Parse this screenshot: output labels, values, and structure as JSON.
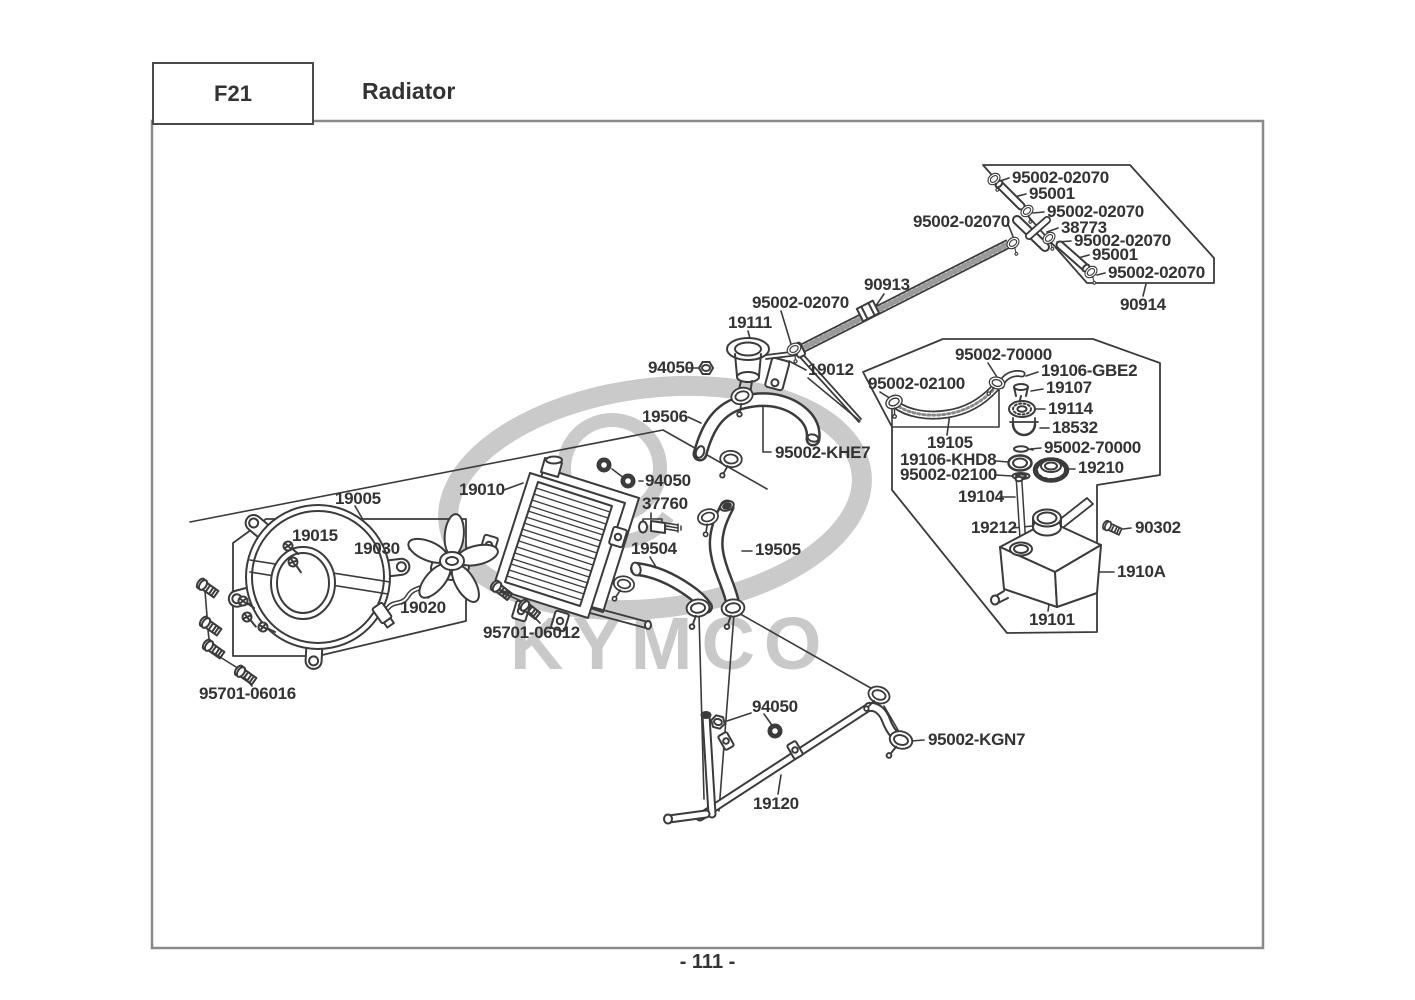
{
  "page": {
    "section_code": "F21",
    "title": "Radiator",
    "page_number": "- 111 -",
    "watermark": "KYMCO",
    "colors": {
      "line": "#3b3b3b",
      "label": "#333333",
      "watermark": "#c9c9c9",
      "border": "#8a8a8a"
    }
  },
  "labels": [
    {
      "text": "95002-02070",
      "x": 1012,
      "y": 178
    },
    {
      "text": "95001",
      "x": 1029,
      "y": 194
    },
    {
      "text": "95002-02070",
      "x": 1047,
      "y": 212
    },
    {
      "text": "38773",
      "x": 1061,
      "y": 228
    },
    {
      "text": "95002-02070",
      "x": 1074,
      "y": 241
    },
    {
      "text": "95001",
      "x": 1092,
      "y": 255
    },
    {
      "text": "95002-02070",
      "x": 1108,
      "y": 273
    },
    {
      "text": "90914",
      "x": 1120,
      "y": 305
    },
    {
      "text": "95002-02070",
      "x": 913,
      "y": 222
    },
    {
      "text": "90913",
      "x": 864,
      "y": 285
    },
    {
      "text": "95002-02070",
      "x": 752,
      "y": 303
    },
    {
      "text": "19111",
      "x": 728,
      "y": 323
    },
    {
      "text": "94050",
      "x": 648,
      "y": 368
    },
    {
      "text": "19012",
      "x": 808,
      "y": 370
    },
    {
      "text": "95002-70000",
      "x": 955,
      "y": 355
    },
    {
      "text": "19106-GBE2",
      "x": 1041,
      "y": 371
    },
    {
      "text": "19107",
      "x": 1046,
      "y": 388
    },
    {
      "text": "19114",
      "x": 1048,
      "y": 409
    },
    {
      "text": "18532",
      "x": 1052,
      "y": 428
    },
    {
      "text": "95002-70000",
      "x": 1044,
      "y": 448
    },
    {
      "text": "19210",
      "x": 1078,
      "y": 468
    },
    {
      "text": "95002-02100",
      "x": 868,
      "y": 384
    },
    {
      "text": "19105",
      "x": 927,
      "y": 443
    },
    {
      "text": "19106-KHD8",
      "x": 900,
      "y": 460
    },
    {
      "text": "95002-02100",
      "x": 900,
      "y": 475
    },
    {
      "text": "19104",
      "x": 958,
      "y": 497
    },
    {
      "text": "19212",
      "x": 971,
      "y": 528
    },
    {
      "text": "90302",
      "x": 1135,
      "y": 528
    },
    {
      "text": "1910A",
      "x": 1117,
      "y": 572
    },
    {
      "text": "19101",
      "x": 1029,
      "y": 620
    },
    {
      "text": "19506",
      "x": 642,
      "y": 417
    },
    {
      "text": "95002-KHE7",
      "x": 775,
      "y": 453
    },
    {
      "text": "94050",
      "x": 645,
      "y": 481
    },
    {
      "text": "37760",
      "x": 642,
      "y": 504
    },
    {
      "text": "19504",
      "x": 631,
      "y": 549
    },
    {
      "text": "19505",
      "x": 755,
      "y": 550
    },
    {
      "text": "19010",
      "x": 459,
      "y": 490
    },
    {
      "text": "95701-06012",
      "x": 483,
      "y": 633
    },
    {
      "text": "19005",
      "x": 335,
      "y": 499
    },
    {
      "text": "19015",
      "x": 292,
      "y": 536
    },
    {
      "text": "19030",
      "x": 354,
      "y": 549
    },
    {
      "text": "19020",
      "x": 400,
      "y": 608
    },
    {
      "text": "95701-06016",
      "x": 199,
      "y": 694
    },
    {
      "text": "94050",
      "x": 752,
      "y": 707
    },
    {
      "text": "95002-KGN7",
      "x": 928,
      "y": 740
    },
    {
      "text": "19120",
      "x": 753,
      "y": 804
    }
  ]
}
